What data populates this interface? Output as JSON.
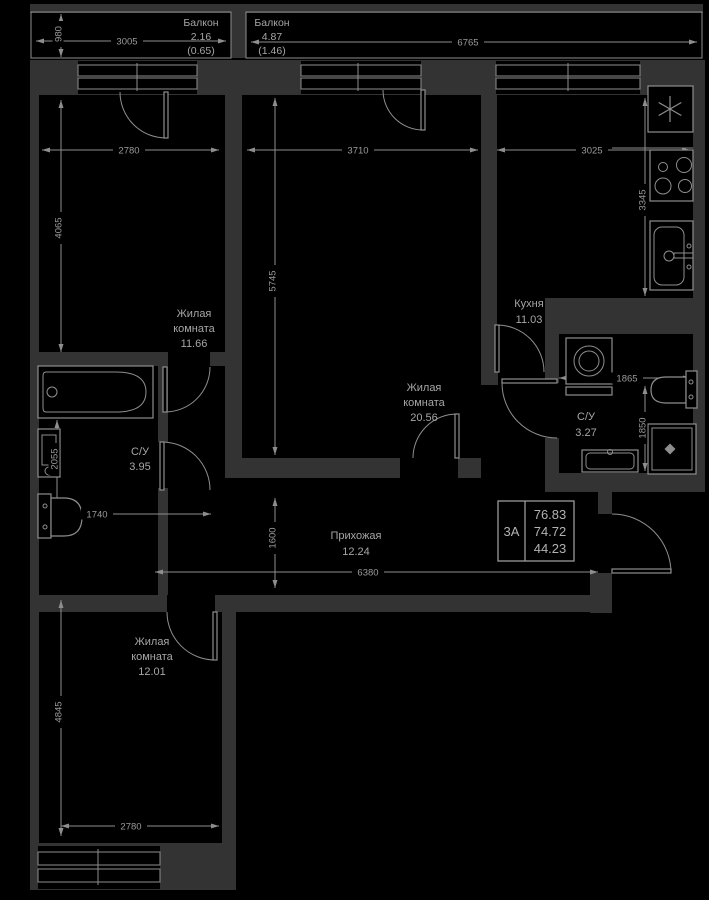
{
  "plan_colors": {
    "background": "#000000",
    "wall_fill": "#333333",
    "line": "#8e8e8e",
    "text": "#a6a6a6"
  },
  "info_box": {
    "type_label": "3А",
    "area_total": "76.83",
    "area_reduced": "74.72",
    "area_living": "44.23"
  },
  "labels": {
    "balcony_left": {
      "name": "Балкон",
      "area": "2.16",
      "area_coeff": "(0.65)"
    },
    "balcony_main": {
      "name": "Балкон",
      "area": "4.87",
      "area_coeff": "(1.46)"
    },
    "living1": {
      "name1": "Жилая",
      "name2": "комната",
      "area": "11.66"
    },
    "living2": {
      "name1": "Жилая",
      "name2": "комната",
      "area": "20.56"
    },
    "living3": {
      "name1": "Жилая",
      "name2": "комната",
      "area": "12.01"
    },
    "kitchen": {
      "name": "Кухня",
      "area": "11.03"
    },
    "bathroom1": {
      "name": "С/У",
      "area": "3.27"
    },
    "bathroom2": {
      "name": "С/У",
      "area": "3.95"
    },
    "hallway": {
      "name": "Прихожая",
      "area": "12.24"
    }
  },
  "dimensions": {
    "balcony_left_width": "3005",
    "balcony_depth": "980",
    "balcony_main_width": "6765",
    "living1_width": "2780",
    "living2_width": "3710",
    "kitchen_width": "3025",
    "living1_height": "4065",
    "living2_height": "5745",
    "kitchen_height": "3345",
    "bathroom1_width": "1865",
    "bathroom1_height": "1850",
    "bathroom2_height": "2055",
    "bathroom2_width": "1740",
    "hallway_height": "1600",
    "hallway_width": "6380",
    "living3_height": "4845",
    "living3_width": "2780"
  },
  "icons": {
    "ventilation_shaft": "asterisk"
  }
}
